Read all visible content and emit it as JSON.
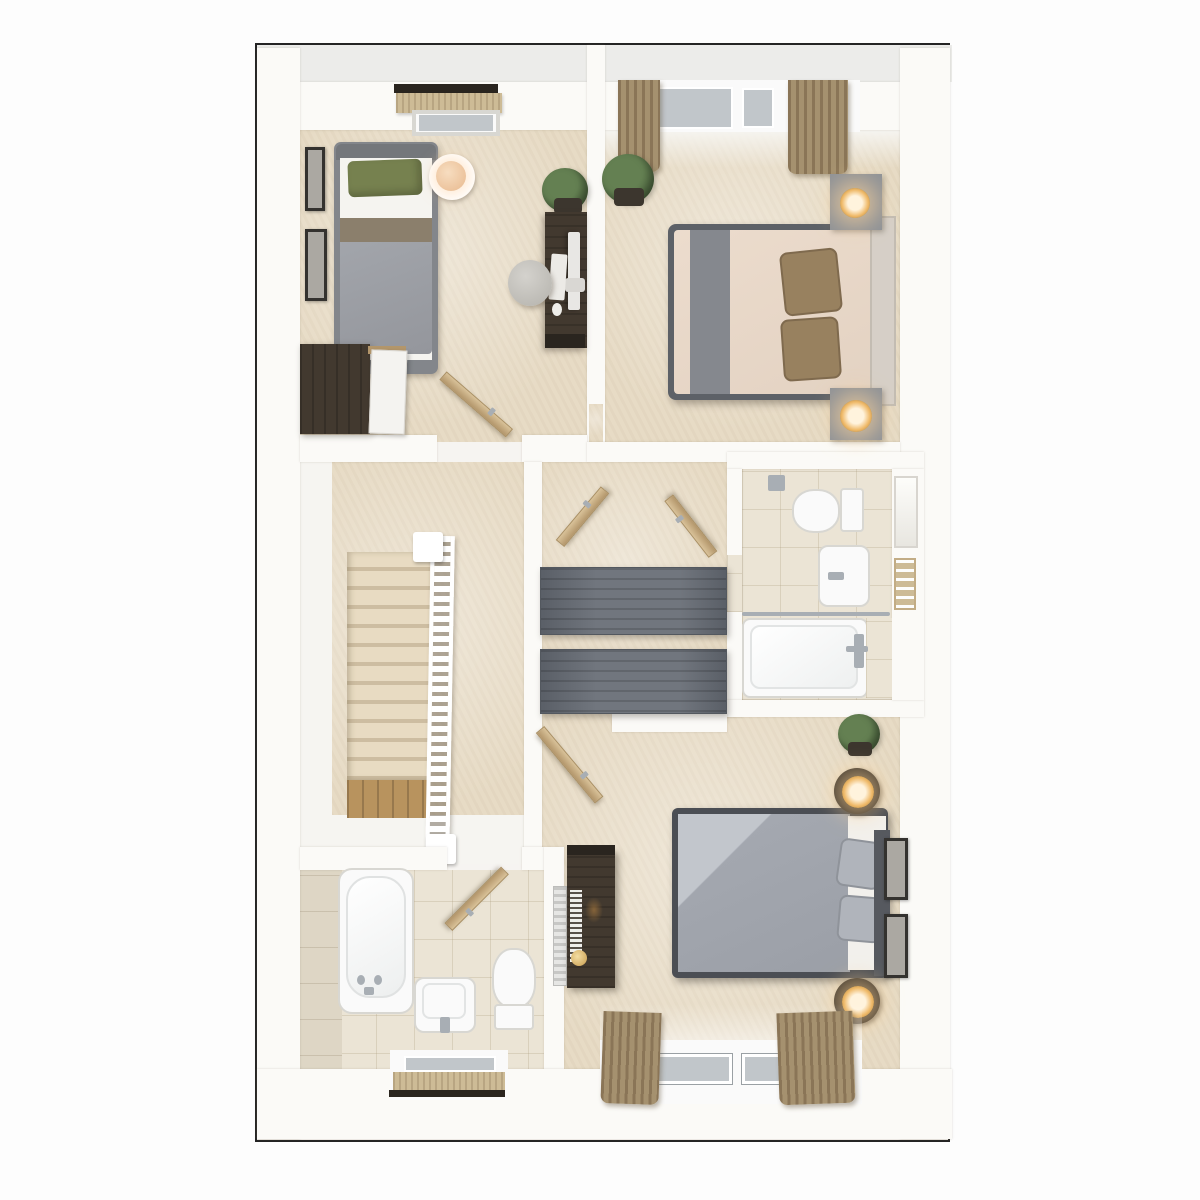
{
  "scene": {
    "type": "3d-top-down-dollhouse-floorplan",
    "description": "Rendered upper-floor plan with three bedrooms, two bathrooms, staircase landing and storage cupboards; beige carpet, white walls, no visible text labels",
    "rooms": [
      {
        "name": "bedroom-1",
        "location": "top-left",
        "items": [
          "single-bed",
          "gray-headboard",
          "green-pillow",
          "white-sheet",
          "taupe-throw",
          "gray-duvet",
          "round-side-table",
          "peach-table-lamp",
          "framed-picture-upper",
          "framed-picture-lower",
          "window-roller-blind",
          "dark-pelmet",
          "desk",
          "computer-monitor",
          "keyboard",
          "mouse",
          "stool",
          "potted-plant",
          "wardrobe",
          "wardrobe-open-white-door",
          "open-door-leaf"
        ]
      },
      {
        "name": "bedroom-2",
        "location": "top-right",
        "items": [
          "double-bed",
          "cream-bedding",
          "gray-bed-runner",
          "brown-pillow-pair",
          "headboard-panel",
          "nightstand-north",
          "nightstand-south",
          "gold-lamp-north",
          "gold-lamp-south",
          "potted-plant",
          "window-two-panes",
          "curtain-left",
          "curtain-right",
          "open-door-leaf",
          "doorway-in-west-wall"
        ]
      },
      {
        "name": "en-suite-bathroom",
        "location": "middle-right",
        "items": [
          "toilet",
          "cistern",
          "toilet-roll-holder",
          "wash-basin",
          "basin-tap",
          "bathtub",
          "shower-rail",
          "shower-mixer",
          "wall-window",
          "towel-rail",
          "open-door-leaf"
        ]
      },
      {
        "name": "landing-and-stairs",
        "location": "middle-left",
        "items": [
          "carpeted-staircase-12-treads",
          "white-balustrade",
          "newel-post-top",
          "newel-post-bottom",
          "wood-lower-landing",
          "white-lower-floor"
        ]
      },
      {
        "name": "storage-cupboards",
        "location": "center",
        "items": [
          "cupboard-unit-upper",
          "cupboard-unit-lower",
          "open-wood-door-left",
          "open-wood-door-right"
        ]
      },
      {
        "name": "bedroom-3",
        "location": "bottom-right",
        "items": [
          "double-bed",
          "gray-duvet",
          "folded-light-throw",
          "gray-pillow-pair",
          "dark-headboard",
          "white-platform-frame",
          "round-bedside-table-north",
          "round-bedside-table-south",
          "glowing-lamp-north",
          "glowing-lamp-south",
          "potted-plant",
          "framed-picture-upper",
          "framed-picture-lower",
          "dresser-desk",
          "desk-clutter-books",
          "gold-dish",
          "radiator",
          "window-two-panes",
          "curtain-left",
          "curtain-right",
          "open-door-leaf"
        ]
      },
      {
        "name": "family-bathroom",
        "location": "bottom-left",
        "items": [
          "bathtub",
          "bath-taps",
          "bath-spout",
          "wash-basin",
          "basin-tap",
          "toilet",
          "cistern",
          "window-roller-blind",
          "tiled-wall-strip",
          "open-door-leaf"
        ]
      }
    ]
  },
  "palette": {
    "outline": "#242424",
    "plan_bg": "#f6f4f1",
    "wall": "#fbfaf7",
    "top_band": "#ececea",
    "carpet": "#e7dbc5",
    "carpet_light": "#efe6d4",
    "white_floor": "#f6f5f1",
    "tile": "#ebe4d5",
    "tile_wall": "#ded6c5",
    "wood_door": "#d9c299",
    "wood_edge": "#b3966b",
    "dark_wood": "#42392f",
    "dark_wood_top": "#2a251f",
    "gray_unit": "#71767e",
    "gray_unit_line": "#5a5f67",
    "stair_tread": "#e8dbc2",
    "stair_shadow": "#cdbda1",
    "stair_wood": "#b8935e",
    "bed1_frame": "#83868b",
    "duvet_gray": "#a2a5ab",
    "pillow_green": "#76814f",
    "band_taupe": "#8b7f6c",
    "sheet_white": "#f5f4f0",
    "bed2_frame": "#5d6167",
    "bed2_sheet": "#ecdccd",
    "runner_gray": "#85888e",
    "pillow_brown": "#98815f",
    "headboard2": "#d6cfc7",
    "nightstand_gray": "#8f9297",
    "lamp_gold": "#efb968",
    "lamp_glow": "#fff3dd",
    "dark_table": "#332e28",
    "bed3_frame": "#4b4e54",
    "duvet3": "#a6aab2",
    "duvet3_light": "#c2c6cc",
    "platform_white": "#f2f0ec",
    "headboard3": "#56595f",
    "pillow3": "#b0b4bb",
    "chrome": "#a8aeb4",
    "glass": "#c1c6ca",
    "curtain": "#a5916f",
    "curtain_dark": "#8a7557",
    "blind": "#cdbb96",
    "plant_green": "#648052",
    "plant_dark": "#46603a",
    "pot_dark": "#3c362e",
    "fixture_white": "#fafafa",
    "fixture_line": "#d8d7d2",
    "radiator_gray": "#e6e6e4",
    "pic_frame": "#34322f",
    "pic_inner": "#aba8a2"
  }
}
